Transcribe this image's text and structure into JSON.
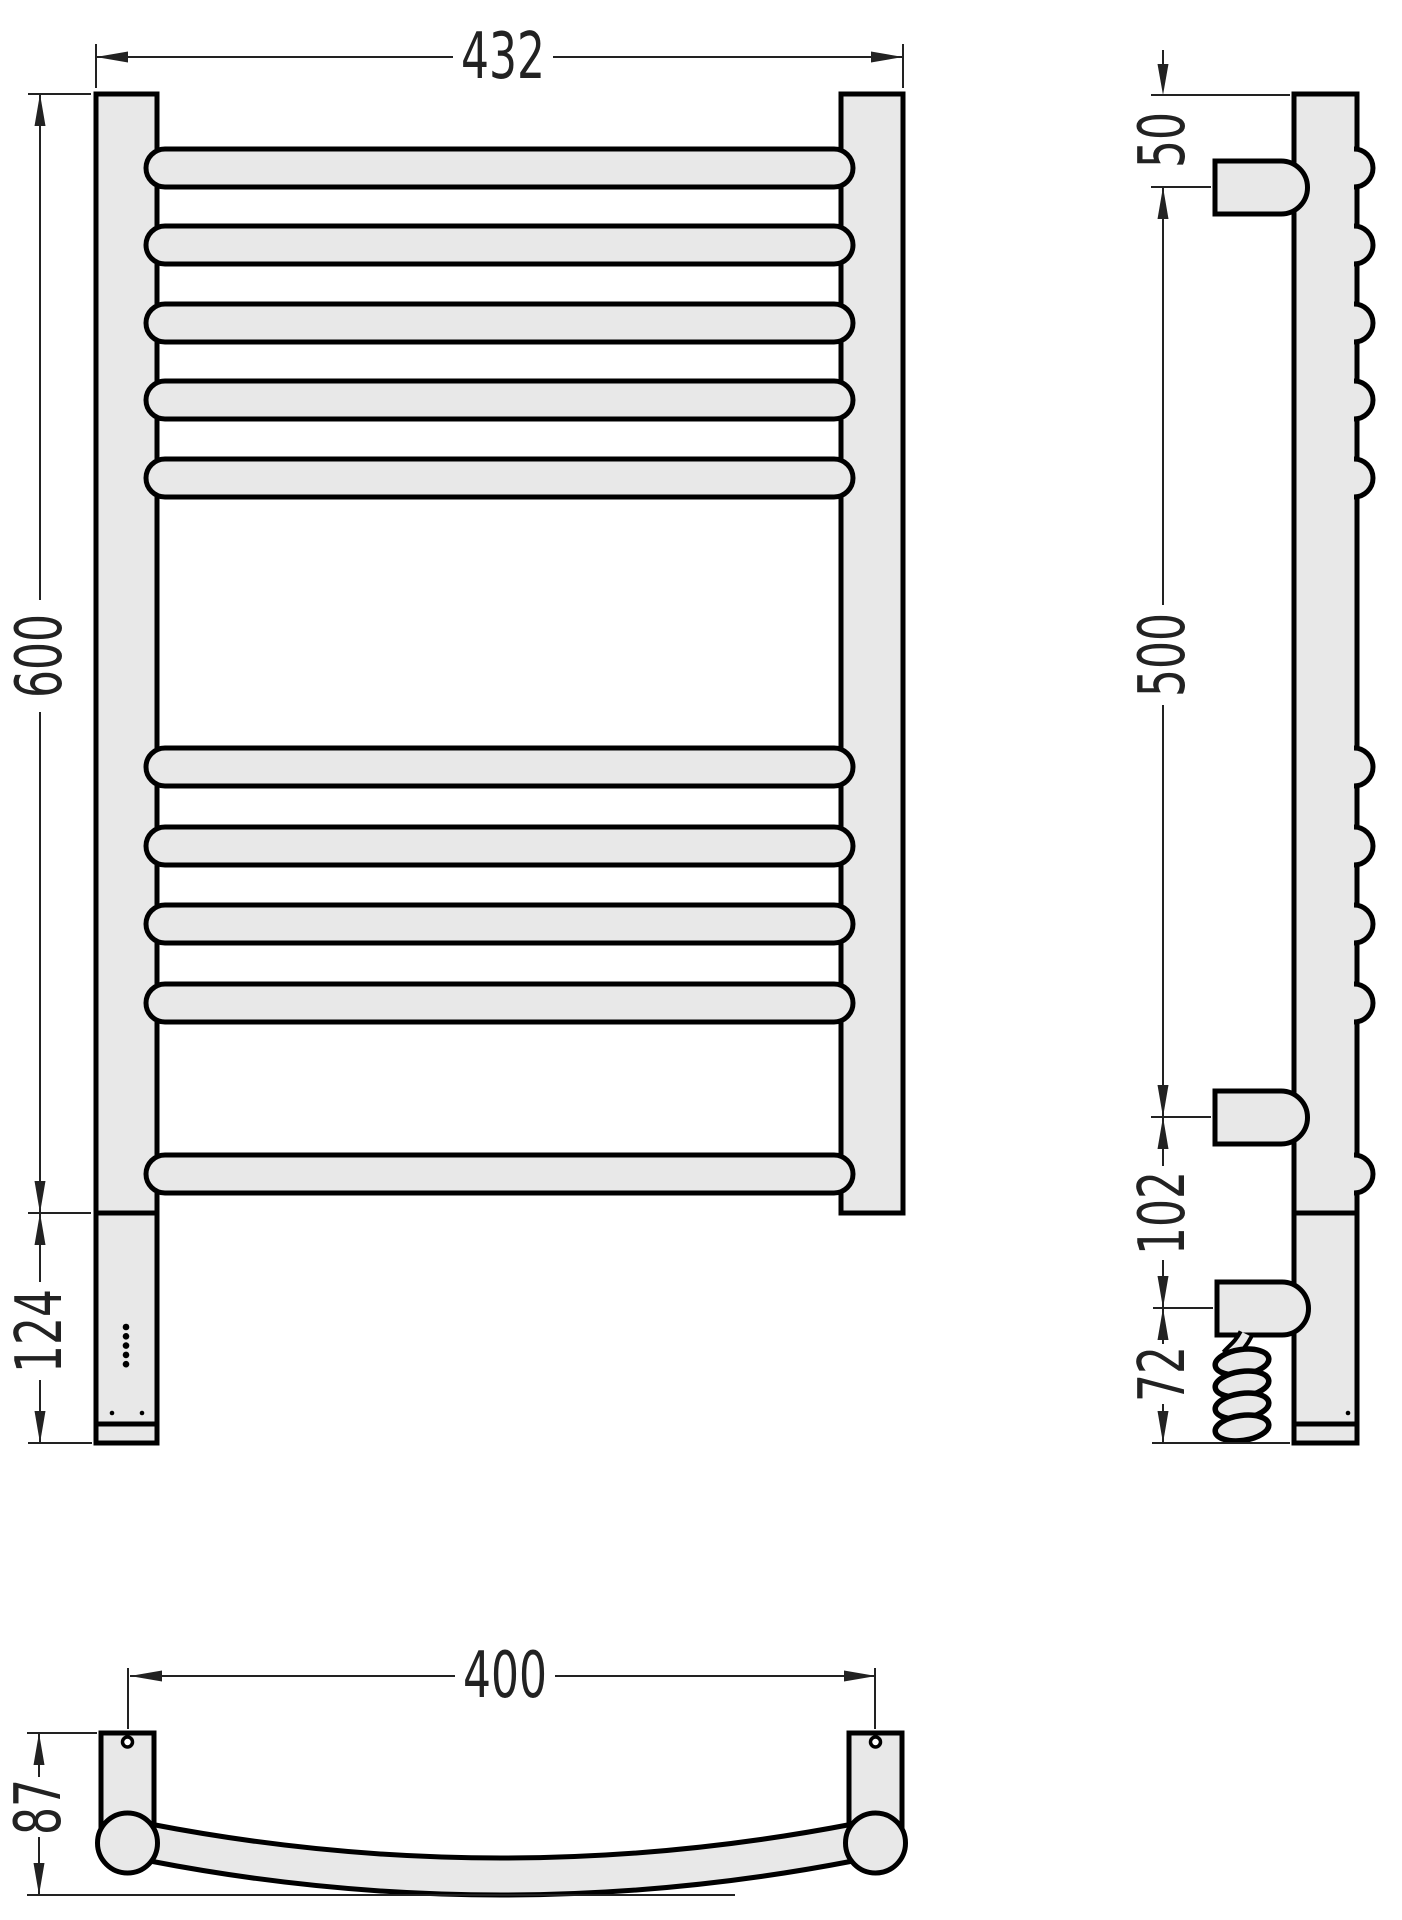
{
  "drawing": {
    "type": "technical-dimension-drawing",
    "subject": "ladder-style heated towel rail with electric element, three orthographic views",
    "bar_count": 10
  },
  "dims": {
    "front_width": "432",
    "front_height": "600",
    "front_bottom": "124",
    "side_top": "50",
    "side_span": "500",
    "side_lower": "102",
    "side_bottom": "72",
    "plan_width": "400",
    "plan_depth": "87"
  },
  "style": {
    "background": "#ffffff",
    "part_fill": "#e8e8e8",
    "outline_color": "#000000",
    "dimension_color": "#222222"
  }
}
